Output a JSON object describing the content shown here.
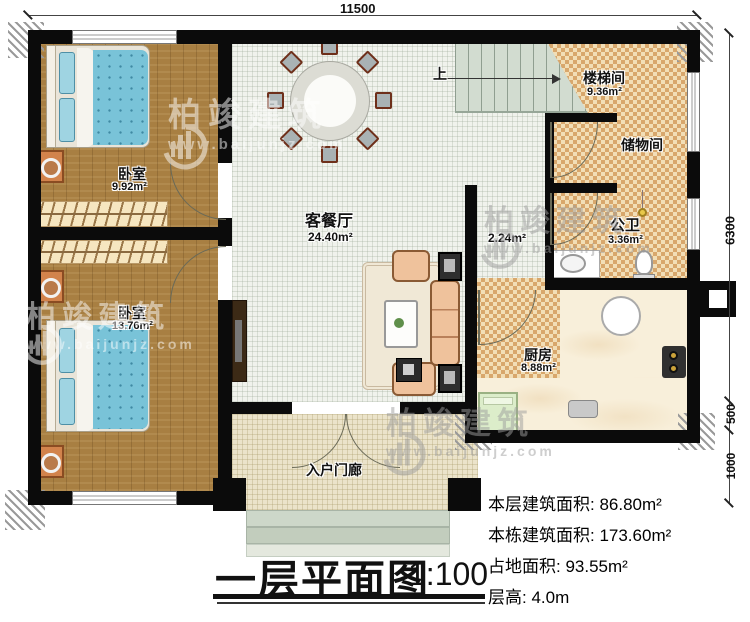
{
  "dimensions": {
    "top_width": "11500",
    "right_height": "6300",
    "right_step": "500",
    "right_porch": "1000"
  },
  "rooms": {
    "bedroom1": {
      "name": "卧室",
      "area": "9.92m²"
    },
    "bedroom2": {
      "name": "卧室",
      "area": "13.76m²"
    },
    "living_dining": {
      "name": "客餐厅",
      "area": "24.40m²"
    },
    "stairwell": {
      "name": "楼梯间",
      "area": "9.36m²"
    },
    "storage": {
      "name": "储物间"
    },
    "bathroom": {
      "name": "公卫",
      "area": "3.36m²"
    },
    "kitchen": {
      "name": "厨房",
      "area": "8.88m²"
    },
    "porch": {
      "name": "入户门廊"
    },
    "hallway": {
      "area": "2.24m²"
    }
  },
  "stairs": {
    "up_label": "上"
  },
  "title": {
    "text": "一层平面图",
    "scale": "1:100"
  },
  "info": {
    "floor_area": "本层建筑面积: 86.80m²",
    "building_area": "本栋建筑面积: 173.60m²",
    "footprint_area": "占地面积: 93.55m²",
    "floor_height": "层高: 4.0m"
  },
  "watermark": {
    "brand": "柏竣建筑",
    "url": "www.baijunjz.com"
  },
  "colors": {
    "wall": "#0b0b0b",
    "wood_floor": "#a87f42",
    "checker_tan": "#d8a76c",
    "stair_green": "#d2dcd0",
    "bed_blue": "#79c3d8",
    "sofa_tan": "#efc29c"
  }
}
